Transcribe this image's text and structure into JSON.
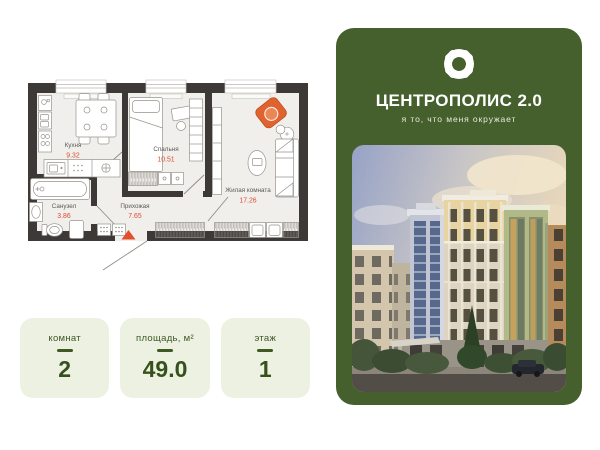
{
  "floor_plan": {
    "rooms": [
      {
        "id": "kitchen",
        "name": "Кухня",
        "area": "9.32"
      },
      {
        "id": "bedroom",
        "name": "Спальня",
        "area": "10.51"
      },
      {
        "id": "living",
        "name": "Жилая комната",
        "area": "17.26"
      },
      {
        "id": "bathroom",
        "name": "Санузел",
        "area": "3.86"
      },
      {
        "id": "hallway",
        "name": "Прихожая",
        "area": "7.65"
      }
    ],
    "wall_color": "#3c3937",
    "floor_color": "#f0efec",
    "area_value_color": "#e0492f",
    "entrance_marker_color": "#e0502d"
  },
  "stats": [
    {
      "label": "комнат",
      "value": "2"
    },
    {
      "label": "площадь, м²",
      "value": "49.0"
    },
    {
      "label": "этаж",
      "value": "1"
    }
  ],
  "brand": {
    "title": "ЦЕНТРОПОЛИС 2.0",
    "subtitle": "я то, что меня окружает",
    "panel_color": "#455f2d",
    "logo_icon": "four-petal-cross-logo",
    "photo_alt": "building-render"
  }
}
